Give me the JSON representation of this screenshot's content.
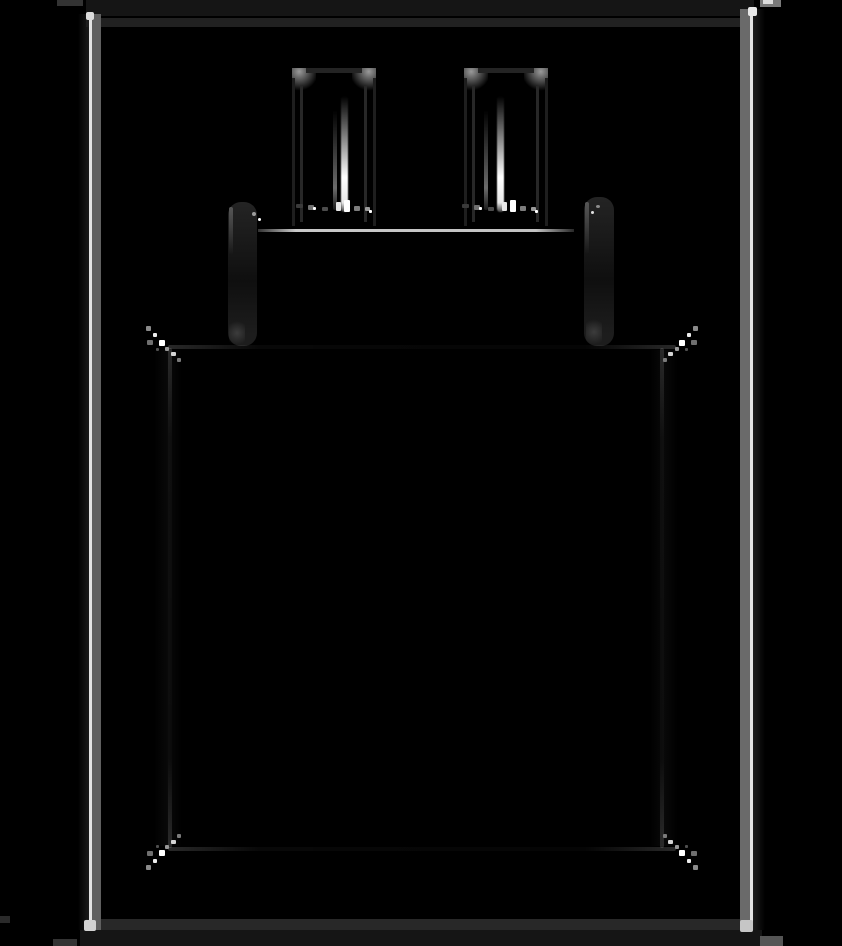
{
  "page": {
    "width_px": 842,
    "height_px": 946,
    "visible_text": "none"
  },
  "drawing": {
    "subject": "two-prong wall power adapter (charger) plug",
    "style": "hand-drawn sketch outline, inverted: faint light strokes on black background",
    "elements": {
      "frame": "rough rectangular border frame around the whole canvas with bright left/right stroke lines, faint top/bottom strokes, white corner dots and small overshoot marks crossing the image edges",
      "prong_left": "left plug prong: rounded bar with gray top-corner highlights and a bright white vertical highlight stroke near its bottom",
      "prong_right": "right plug prong: rounded bar with gray top-corner highlights and a bright white vertical highlight stroke near its bottom",
      "neck": "plug base below the prongs: bright horizontal top edge line, dark rounded side bars with gray streaks",
      "body": "large rounded-square adapter body: nearly invisible dark edges with bright sparkle stroke clusters at all four corners"
    }
  },
  "colors": {
    "bg": "#000000",
    "strip": "#151515",
    "top-band": "#212121",
    "bottom-band": "#282828",
    "lead": "#1c1c1c",
    "frame-bright": "#e2e2e2",
    "band-left": "#5f5f5f",
    "band-right": "#6a6a6a",
    "corner-dot": "#dcdcdc",
    "overshoot-dark": "#333333",
    "overshoot-gray": "#7a7a7a",
    "prong-cap": "#9a9a9a",
    "prong-edge": "#242424",
    "highlight": "#ffffff",
    "neck-line": "#c9c9c9",
    "bar-top": "#242424",
    "bar-mid": "#0f0f0f",
    "bar-end": "#1d1d1d",
    "streak": "#565656",
    "foot": "#3c3c3c",
    "sparkle-bright": "#ffffff",
    "sparkle-mid": "#d4d4d4",
    "sparkle-dim": "#8a8a8a"
  }
}
